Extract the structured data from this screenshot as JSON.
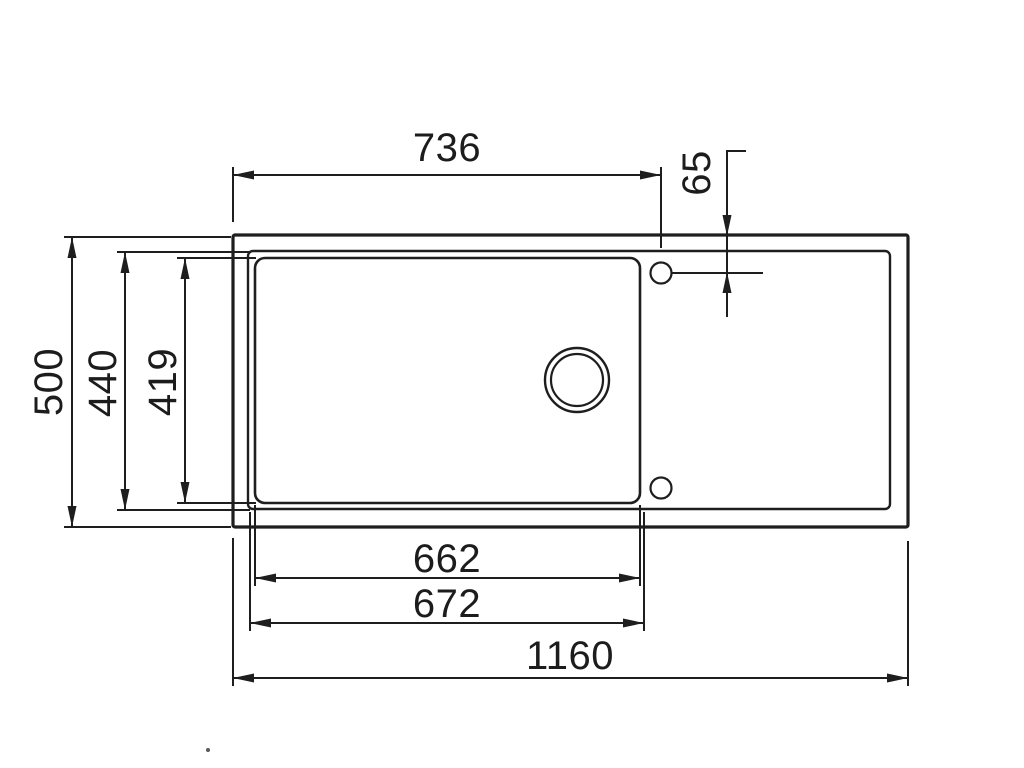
{
  "drawing": {
    "subject": "kitchen-sink-top-view-technical-drawing",
    "background_color": "#ffffff",
    "line_color": "#1e1e1e",
    "dimensions": {
      "left_edge_to_tap_hole": "736",
      "tap_hole_offset_from_top": "65",
      "overall_depth": "500",
      "rim_depth": "440",
      "bowl_depth": "419",
      "bowl_inner_width": "662",
      "bowl_outer_width": "672",
      "overall_width": "1160"
    }
  }
}
